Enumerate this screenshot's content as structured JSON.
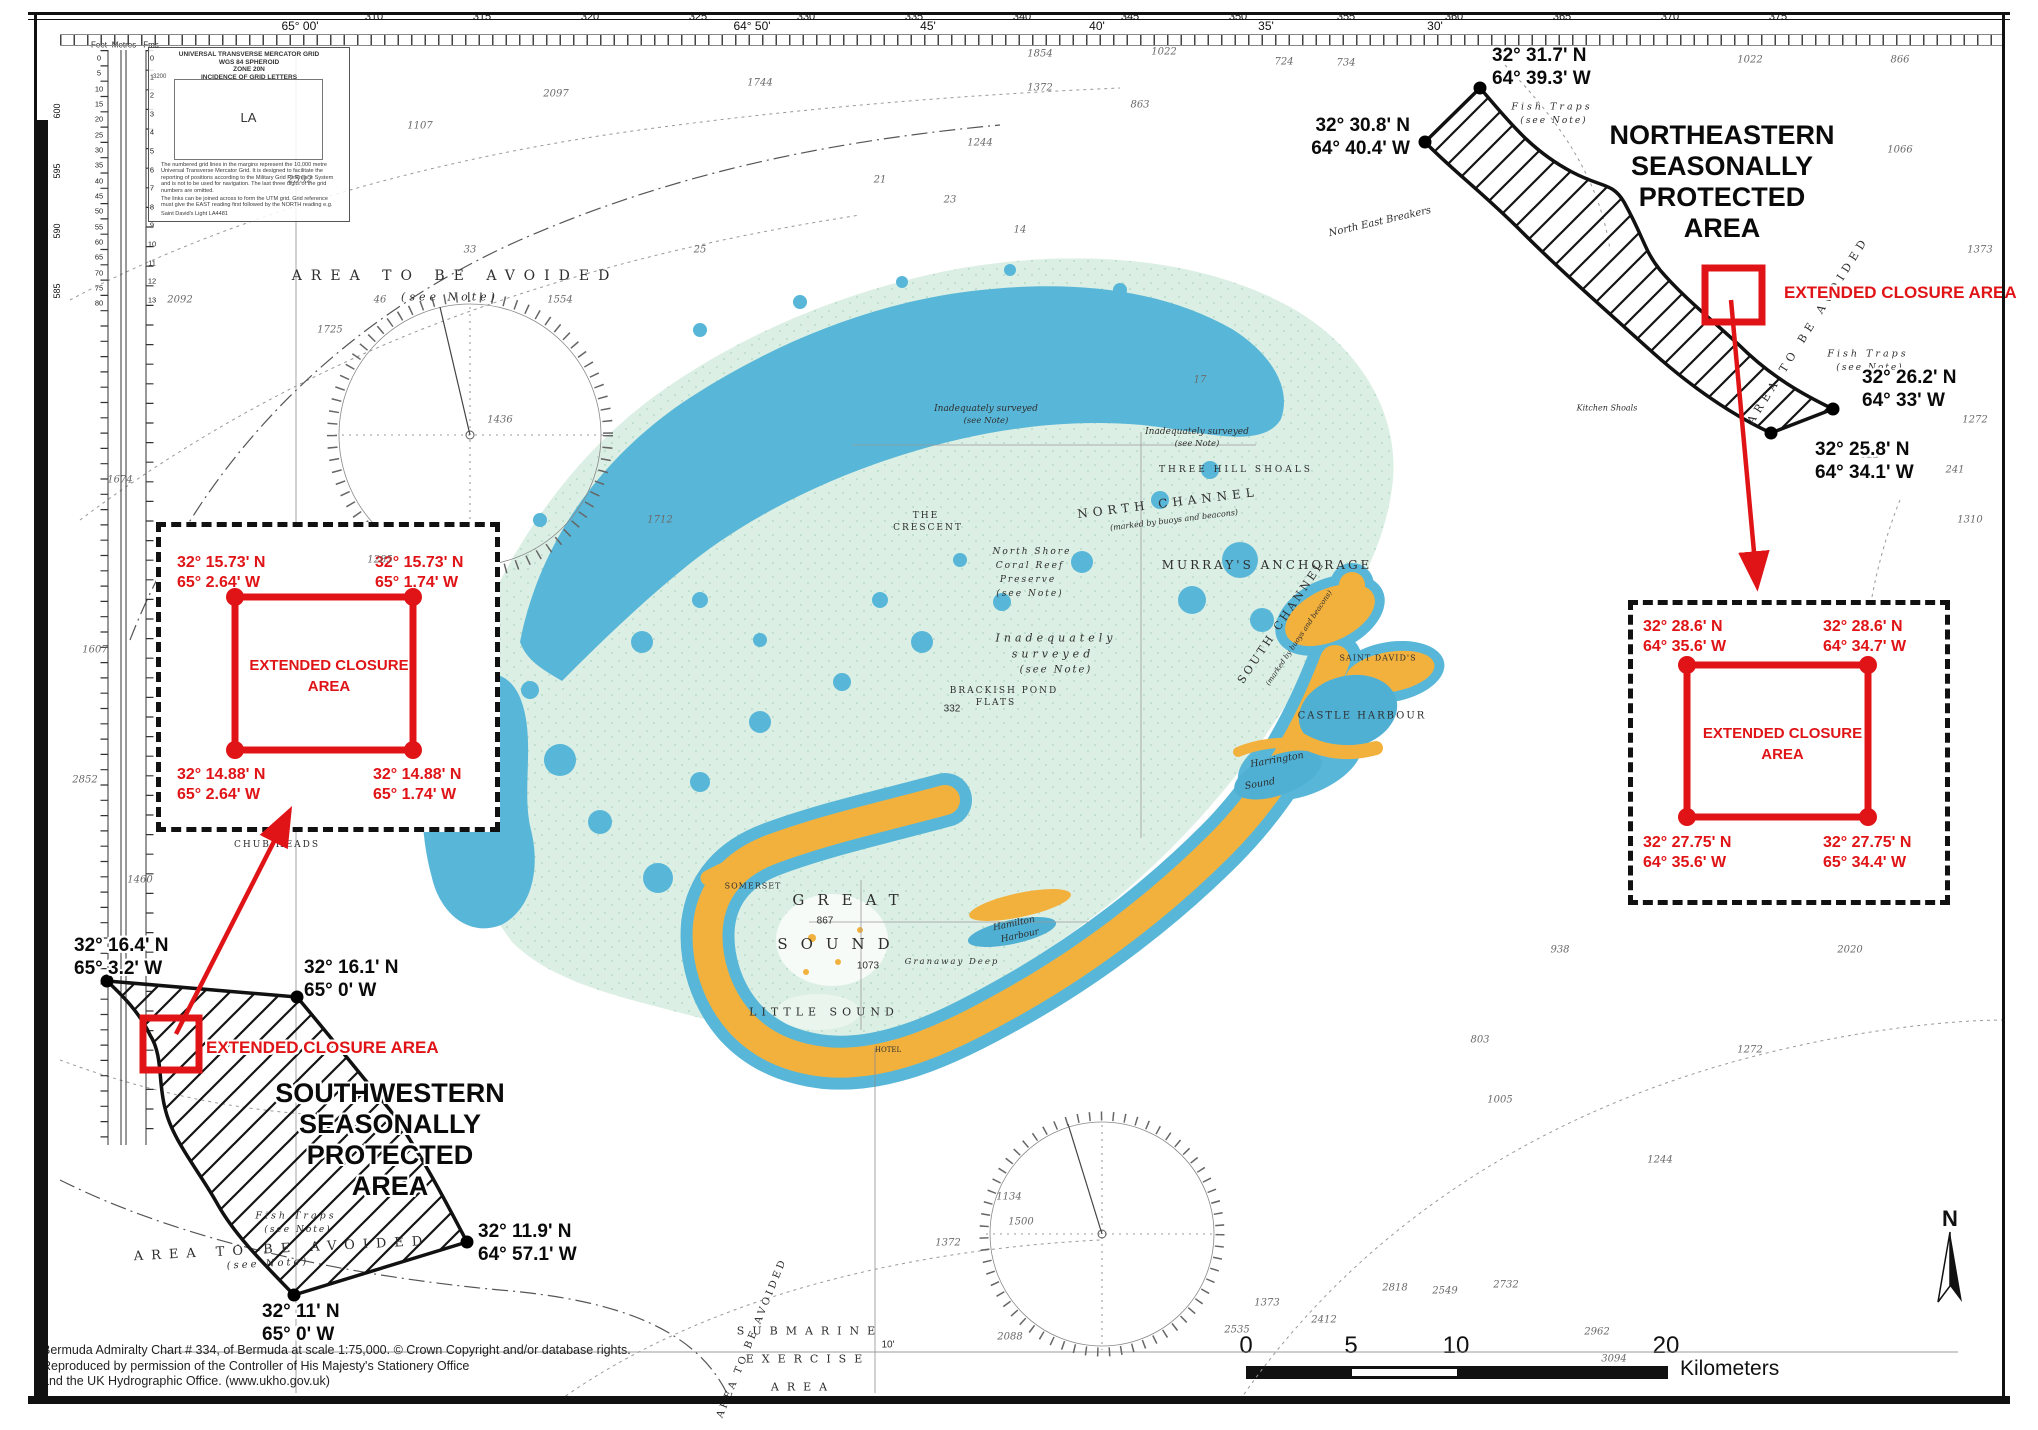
{
  "colors": {
    "red": "#e01417",
    "island_orange": "#f2b13d",
    "reef_blue": "#58b7d8",
    "platform_green": "#dcefe4",
    "hatch_black": "#111111"
  },
  "frame": {
    "north_label": "N"
  },
  "axis": {
    "top": [
      {
        "t": "310",
        "x": 374,
        "y": 17,
        "s": 11
      },
      {
        "t": "315",
        "x": 482,
        "y": 17,
        "s": 11
      },
      {
        "t": "320",
        "x": 590,
        "y": 17,
        "s": 11
      },
      {
        "t": "325",
        "x": 698,
        "y": 17,
        "s": 11
      },
      {
        "t": "330",
        "x": 806,
        "y": 17,
        "s": 11
      },
      {
        "t": "335",
        "x": 914,
        "y": 17,
        "s": 11
      },
      {
        "t": "340",
        "x": 1022,
        "y": 17,
        "s": 11
      },
      {
        "t": "345",
        "x": 1130,
        "y": 17,
        "s": 11
      },
      {
        "t": "350",
        "x": 1238,
        "y": 17,
        "s": 11
      },
      {
        "t": "355",
        "x": 1346,
        "y": 17,
        "s": 11
      },
      {
        "t": "360",
        "x": 1454,
        "y": 17,
        "s": 11
      },
      {
        "t": "365",
        "x": 1562,
        "y": 17,
        "s": 11
      },
      {
        "t": "370",
        "x": 1670,
        "y": 17,
        "s": 11
      },
      {
        "t": "375",
        "x": 1778,
        "y": 17,
        "s": 11
      },
      {
        "t": "65° 00'",
        "x": 300,
        "y": 26,
        "s": 12
      },
      {
        "t": "64° 50'",
        "x": 752,
        "y": 26,
        "s": 12
      },
      {
        "t": "45'",
        "x": 928,
        "y": 26,
        "s": 12
      },
      {
        "t": "40'",
        "x": 1097,
        "y": 26,
        "s": 12
      },
      {
        "t": "35'",
        "x": 1266,
        "y": 26,
        "s": 12
      },
      {
        "t": "30'",
        "x": 1435,
        "y": 26,
        "s": 12
      }
    ],
    "left": [
      {
        "t": "600",
        "x": 57,
        "y": 111,
        "s": 9,
        "r": -90
      },
      {
        "t": "595",
        "x": 57,
        "y": 171,
        "s": 9,
        "r": -90
      },
      {
        "t": "590",
        "x": 57,
        "y": 231,
        "s": 9,
        "r": -90
      },
      {
        "t": "585",
        "x": 57,
        "y": 291,
        "s": 9,
        "r": -90
      }
    ]
  },
  "legend": {
    "ruler_labels": [
      {
        "t": "Feet",
        "x": 99,
        "y": 45,
        "s": 8
      },
      {
        "t": "Metres",
        "x": 124,
        "y": 45,
        "s": 8
      },
      {
        "t": "Fms",
        "x": 151,
        "y": 45,
        "s": 8
      },
      {
        "t": "0",
        "x": 99,
        "y": 58,
        "s": 7.5
      },
      {
        "t": "5",
        "x": 99,
        "y": 73,
        "s": 7.5
      },
      {
        "t": "10",
        "x": 99,
        "y": 89,
        "s": 7.5
      },
      {
        "t": "15",
        "x": 99,
        "y": 104,
        "s": 7.5
      },
      {
        "t": "20",
        "x": 99,
        "y": 119,
        "s": 7.5
      },
      {
        "t": "25",
        "x": 99,
        "y": 135,
        "s": 7.5
      },
      {
        "t": "30",
        "x": 99,
        "y": 150,
        "s": 7.5
      },
      {
        "t": "35",
        "x": 99,
        "y": 165,
        "s": 7.5
      },
      {
        "t": "40",
        "x": 99,
        "y": 181,
        "s": 7.5
      },
      {
        "t": "45",
        "x": 99,
        "y": 196,
        "s": 7.5
      },
      {
        "t": "50",
        "x": 99,
        "y": 211,
        "s": 7.5
      },
      {
        "t": "55",
        "x": 99,
        "y": 227,
        "s": 7.5
      },
      {
        "t": "60",
        "x": 99,
        "y": 242,
        "s": 7.5
      },
      {
        "t": "65",
        "x": 99,
        "y": 257,
        "s": 7.5
      },
      {
        "t": "70",
        "x": 99,
        "y": 273,
        "s": 7.5
      },
      {
        "t": "75",
        "x": 99,
        "y": 288,
        "s": 7.5
      },
      {
        "t": "80",
        "x": 99,
        "y": 303,
        "s": 7.5
      },
      {
        "t": "0",
        "x": 152,
        "y": 58,
        "s": 7.5
      },
      {
        "t": "1",
        "x": 152,
        "y": 77,
        "s": 7.5
      },
      {
        "t": "2",
        "x": 152,
        "y": 95,
        "s": 7.5
      },
      {
        "t": "3",
        "x": 152,
        "y": 114,
        "s": 7.5
      },
      {
        "t": "4",
        "x": 152,
        "y": 132,
        "s": 7.5
      },
      {
        "t": "5",
        "x": 152,
        "y": 151,
        "s": 7.5
      },
      {
        "t": "6",
        "x": 152,
        "y": 170,
        "s": 7.5
      },
      {
        "t": "7",
        "x": 152,
        "y": 188,
        "s": 7.5
      },
      {
        "t": "8",
        "x": 152,
        "y": 207,
        "s": 7.5
      },
      {
        "t": "9",
        "x": 152,
        "y": 225,
        "s": 7.5
      },
      {
        "t": "10",
        "x": 152,
        "y": 244,
        "s": 7.5
      },
      {
        "t": "11",
        "x": 152,
        "y": 263,
        "s": 7.5
      },
      {
        "t": "12",
        "x": 152,
        "y": 281,
        "s": 7.5
      },
      {
        "t": "13",
        "x": 152,
        "y": 300,
        "s": 7.5
      }
    ],
    "utm_box": {
      "title_lines": [
        "UNIVERSAL TRANSVERSE MERCATOR GRID",
        "WGS 84 SPHEROID",
        "ZONE 20N",
        "INCIDENCE OF GRID LETTERS"
      ],
      "grid_letter": "LA",
      "corner_label": "3200",
      "notes": [
        "The numbered grid lines in the margins represent the 10,000 metre Universal Transverse Mercator Grid. It is designed to facilitate the reporting of positions according to the Military Grid Reference System and is not to be used for navigation. The last three digits of the grid numbers are omitted.",
        "The links can be joined across to form the UTM grid. Grid reference must give the EAST reading first followed by the NORTH reading e.g.",
        "Saint David's Light LA4481"
      ]
    }
  },
  "copyright_lines": [
    "Bermuda Admiralty Chart # 334, of Bermuda at scale 1:75,000. © Crown Copyright and/or database rights.",
    "Reproduced by permission of the Controller of His Majesty's Stationery Office",
    "and the UK Hydrographic Office. (www.ukho.gov.uk)"
  ],
  "scalebar": {
    "ticks": [
      "0",
      "5",
      "10",
      "20"
    ],
    "unit": "Kilometers"
  },
  "protected_areas": {
    "northeastern": {
      "title_lines": [
        "NORTHEASTERN",
        "SEASONALLY",
        "PROTECTED",
        "AREA"
      ],
      "closure_label": "EXTENDED CLOSURE AREA",
      "vertices": [
        {
          "lat": "32° 31.7' N",
          "lon": "64° 39.3' W"
        },
        {
          "lat": "32° 30.8' N",
          "lon": "64° 40.4' W"
        },
        {
          "lat": "32° 26.2' N",
          "lon": "64° 33' W"
        },
        {
          "lat": "32° 25.8' N",
          "lon": "64° 34.1' W"
        }
      ]
    },
    "southwestern": {
      "title_lines": [
        "SOUTHWESTERN",
        "SEASONALLY",
        "PROTECTED",
        "AREA"
      ],
      "closure_label": "EXTENDED CLOSURE AREA",
      "vertices": [
        {
          "lat": "32° 16.4' N",
          "lon": "65° 3.2' W"
        },
        {
          "lat": "32° 16.1' N",
          "lon": "65° 0' W"
        },
        {
          "lat": "32° 11.9' N",
          "lon": "64° 57.1' W"
        },
        {
          "lat": "32° 11' N",
          "lon": "65° 0' W"
        }
      ]
    }
  },
  "insets": {
    "northeastern": {
      "label_lines": [
        "EXTENDED CLOSURE",
        "AREA"
      ],
      "corners": {
        "tl": {
          "lat": "32° 28.6' N",
          "lon": "64° 35.6' W"
        },
        "tr": {
          "lat": "32° 28.6' N",
          "lon": "64° 34.7' W"
        },
        "bl": {
          "lat": "32° 27.75' N",
          "lon": "64° 35.6' W"
        },
        "br": {
          "lat": "32° 27.75' N",
          "lon": "65° 34.4' W"
        }
      }
    },
    "southwestern": {
      "label_lines": [
        "EXTENDED CLOSURE",
        "AREA"
      ],
      "corners": {
        "tl": {
          "lat": "32° 15.73' N",
          "lon": "65° 2.64' W"
        },
        "tr": {
          "lat": "32° 15.73' N",
          "lon": "65° 1.74' W"
        },
        "bl": {
          "lat": "32° 14.88' N",
          "lon": "65° 2.64' W"
        },
        "br": {
          "lat": "32° 14.88' N",
          "lon": "65° 1.74' W"
        }
      }
    }
  },
  "map_labels": [
    {
      "n": "area-to-be-avoided-nw",
      "t": "AREA TO BE AVOIDED",
      "x": 455,
      "y": 276,
      "s": 14,
      "ls": 9
    },
    {
      "n": "area-to-be-avoided-nw-note",
      "t": "(see Note)",
      "x": 450,
      "y": 297,
      "s": 11,
      "ls": 4,
      "c": "it"
    },
    {
      "n": "north-channel",
      "t": "NORTH CHANNEL",
      "x": 1168,
      "y": 503,
      "s": 12,
      "ls": 5,
      "r": -7
    },
    {
      "n": "north-channel-note",
      "t": "(marked by buoys and beacons)",
      "x": 1174,
      "y": 520,
      "s": 8,
      "c": "it",
      "r": -7
    },
    {
      "n": "murrays-anchorage",
      "t": "MURRAY'S ANCHORAGE",
      "x": 1267,
      "y": 565,
      "s": 12,
      "ls": 3
    },
    {
      "n": "the-crescent",
      "t": "THE",
      "x": 926,
      "y": 516,
      "s": 9,
      "ls": 2
    },
    {
      "n": "the-crescent",
      "t": "CRESCENT",
      "x": 928,
      "y": 528,
      "s": 9,
      "ls": 2
    },
    {
      "n": "coral-reef-preserve",
      "t": "North Shore",
      "x": 1032,
      "y": 552,
      "s": 9,
      "c": "it",
      "ls": 2
    },
    {
      "n": "coral-reef-preserve",
      "t": "Coral Reef",
      "x": 1030,
      "y": 566,
      "s": 9,
      "c": "it",
      "ls": 2
    },
    {
      "n": "coral-reef-preserve",
      "t": "Preserve",
      "x": 1028,
      "y": 580,
      "s": 9,
      "c": "it",
      "ls": 2
    },
    {
      "n": "coral-reef-preserve",
      "t": "(see Note)",
      "x": 1030,
      "y": 594,
      "s": 9,
      "c": "it",
      "ls": 2
    },
    {
      "n": "inadequately-surveyed",
      "t": "Inadequately",
      "x": 1056,
      "y": 638,
      "s": 11,
      "c": "it",
      "ls": 4
    },
    {
      "n": "inadequately-surveyed",
      "t": "surveyed",
      "x": 1053,
      "y": 654,
      "s": 11,
      "c": "it",
      "ls": 4
    },
    {
      "n": "inadequately-surveyed",
      "t": "(see Note)",
      "x": 1056,
      "y": 670,
      "s": 10,
      "c": "it",
      "ls": 2
    },
    {
      "n": "inadequately-surveyed",
      "t": "Inadequately surveyed",
      "x": 1197,
      "y": 432,
      "s": 9,
      "c": "it"
    },
    {
      "n": "inadequately-surveyed",
      "t": "(see Note)",
      "x": 1197,
      "y": 444,
      "s": 8.5,
      "c": "it"
    },
    {
      "n": "inadequately-surveyed",
      "t": "Inadequately surveyed",
      "x": 986,
      "y": 409,
      "s": 9,
      "c": "it"
    },
    {
      "n": "inadequately-surveyed",
      "t": "(see Note)",
      "x": 986,
      "y": 421,
      "s": 8.5,
      "c": "it"
    },
    {
      "n": "brackish-pond-flats",
      "t": "BRACKISH POND",
      "x": 1004,
      "y": 691,
      "s": 9,
      "ls": 2
    },
    {
      "n": "brackish-pond-flats",
      "t": "FLATS",
      "x": 996,
      "y": 703,
      "s": 9,
      "ls": 2
    },
    {
      "n": "three-hill-shoals",
      "t": "THREE HILL SHOALS",
      "x": 1236,
      "y": 470,
      "s": 9,
      "ls": 3
    },
    {
      "n": "south-channel",
      "t": "SOUTH CHANNEL",
      "x": 1281,
      "y": 622,
      "s": 11,
      "ls": 3,
      "r": -56
    },
    {
      "n": "south-channel-note",
      "t": "(marked by buoys and beacons)",
      "x": 1299,
      "y": 638,
      "s": 7,
      "c": "it",
      "r": -56
    },
    {
      "n": "great-sound",
      "t": "GREAT",
      "x": 852,
      "y": 900,
      "s": 15,
      "ls": 13
    },
    {
      "n": "great-sound",
      "t": "SOUND",
      "x": 840,
      "y": 944,
      "s": 15,
      "ls": 13
    },
    {
      "n": "little-sound",
      "t": "LITTLE SOUND",
      "x": 824,
      "y": 1012,
      "s": 11,
      "ls": 5
    },
    {
      "n": "hamilton-harbour",
      "t": "Hamilton",
      "x": 1014,
      "y": 924,
      "s": 9,
      "c": "it",
      "r": -12
    },
    {
      "n": "hamilton-harbour",
      "t": "Harbour",
      "x": 1020,
      "y": 936,
      "s": 9,
      "c": "it",
      "r": -12
    },
    {
      "n": "castle-harbour",
      "t": "CASTLE HARBOUR",
      "x": 1362,
      "y": 716,
      "s": 10,
      "ls": 2
    },
    {
      "n": "harrington-sound",
      "t": "Harrington",
      "x": 1277,
      "y": 760,
      "s": 9.5,
      "c": "it",
      "r": -10
    },
    {
      "n": "harrington-sound",
      "t": "Sound",
      "x": 1260,
      "y": 784,
      "s": 9.5,
      "c": "it",
      "r": -10
    },
    {
      "n": "saint-davids",
      "t": "SAINT DAVID'S",
      "x": 1378,
      "y": 658,
      "s": 8,
      "ls": 1
    },
    {
      "n": "somerset",
      "t": "SOMERSET",
      "x": 753,
      "y": 886,
      "s": 8,
      "ls": 1
    },
    {
      "n": "north-east-breakers",
      "t": "North East Breakers",
      "x": 1380,
      "y": 222,
      "s": 10,
      "c": "it",
      "r": -13
    },
    {
      "n": "fish-traps",
      "t": "Fish Traps",
      "x": 1552,
      "y": 107,
      "s": 9.5,
      "c": "it",
      "ls": 3
    },
    {
      "n": "fish-traps",
      "t": "(see Note)",
      "x": 1554,
      "y": 121,
      "s": 9,
      "c": "it",
      "ls": 2
    },
    {
      "n": "fish-traps",
      "t": "Fish Traps",
      "x": 1868,
      "y": 354,
      "s": 9.5,
      "c": "it",
      "ls": 3
    },
    {
      "n": "fish-traps",
      "t": "(see Note)",
      "x": 1870,
      "y": 368,
      "s": 9,
      "c": "it",
      "ls": 2
    },
    {
      "n": "fish-traps",
      "t": "Fish Traps",
      "x": 296,
      "y": 1216,
      "s": 9.5,
      "c": "it",
      "ls": 3
    },
    {
      "n": "fish-traps",
      "t": "(see Note)",
      "x": 298,
      "y": 1230,
      "s": 9,
      "c": "it",
      "ls": 2
    },
    {
      "n": "area-to-be-avoided-sw",
      "t": "AREA TO BE AVOIDED",
      "x": 282,
      "y": 1249,
      "s": 13,
      "ls": 8,
      "r": -3
    },
    {
      "n": "area-to-be-avoided-sw-note",
      "t": "(see Note)",
      "x": 268,
      "y": 1264,
      "s": 10,
      "ls": 3,
      "r": -3,
      "c": "it"
    },
    {
      "n": "area-to-be-avoided-e",
      "t": "AREA TO BE AVOIDED",
      "x": 1808,
      "y": 330,
      "s": 11,
      "ls": 5,
      "r": -58
    },
    {
      "n": "area-to-be-avoided-s",
      "t": "AREA TO BE AVOIDED",
      "x": 752,
      "y": 1338,
      "s": 10,
      "ls": 3,
      "r": -68
    },
    {
      "n": "submarine-exercise-area",
      "t": "SUBMARINE",
      "x": 810,
      "y": 1331,
      "s": 11,
      "ls": 8
    },
    {
      "n": "submarine-exercise-area",
      "t": "EXERCISE",
      "x": 808,
      "y": 1359,
      "s": 11,
      "ls": 8
    },
    {
      "n": "submarine-exercise-area",
      "t": "AREA",
      "x": 803,
      "y": 1387,
      "s": 11,
      "ls": 8
    },
    {
      "n": "chub-heads",
      "t": "CHUB HEADS",
      "x": 277,
      "y": 845,
      "s": 9,
      "ls": 2
    },
    {
      "n": "kitchen-shoals",
      "t": "Kitchen Shoals",
      "x": 1607,
      "y": 408,
      "s": 8,
      "c": "it"
    },
    {
      "n": "hotel",
      "t": "HOTEL",
      "x": 888,
      "y": 1050,
      "s": 7
    },
    {
      "n": "granaway-deep",
      "t": "Granaway Deep",
      "x": 952,
      "y": 962,
      "s": 8.5,
      "c": "it",
      "ls": 2
    },
    {
      "n": "panel-number",
      "t": "867",
      "x": 825,
      "y": 921,
      "s": 10,
      "c": "sans"
    },
    {
      "n": "panel-number",
      "t": "1073",
      "x": 868,
      "y": 966,
      "s": 10,
      "c": "sans"
    },
    {
      "n": "panel-number",
      "t": "332",
      "x": 952,
      "y": 709,
      "s": 10,
      "c": "sans"
    },
    {
      "n": "latitude-label",
      "t": "10'",
      "x": 888,
      "y": 1345,
      "s": 10,
      "c": "sans"
    }
  ],
  "soundings": [
    {
      "t": "1854",
      "x": 1040,
      "y": 54
    },
    {
      "t": "1022",
      "x": 1164,
      "y": 52
    },
    {
      "t": "724",
      "x": 1284,
      "y": 62
    },
    {
      "t": "734",
      "x": 1346,
      "y": 63
    },
    {
      "t": "1372",
      "x": 1040,
      "y": 88
    },
    {
      "t": "863",
      "x": 1140,
      "y": 105
    },
    {
      "t": "1244",
      "x": 980,
      "y": 143
    },
    {
      "t": "1744",
      "x": 760,
      "y": 83
    },
    {
      "t": "2097",
      "x": 556,
      "y": 94
    },
    {
      "t": "1107",
      "x": 420,
      "y": 126
    },
    {
      "t": "2592",
      "x": 300,
      "y": 180
    },
    {
      "t": "2092",
      "x": 180,
      "y": 300
    },
    {
      "t": "1674",
      "x": 120,
      "y": 480
    },
    {
      "t": "1607",
      "x": 95,
      "y": 650
    },
    {
      "t": "2852",
      "x": 85,
      "y": 780
    },
    {
      "t": "1460",
      "x": 140,
      "y": 880
    },
    {
      "t": "1725",
      "x": 330,
      "y": 330
    },
    {
      "t": "1554",
      "x": 560,
      "y": 300
    },
    {
      "t": "1436",
      "x": 500,
      "y": 420
    },
    {
      "t": "1712",
      "x": 660,
      "y": 520
    },
    {
      "t": "1285",
      "x": 380,
      "y": 560
    },
    {
      "t": "2535",
      "x": 1237,
      "y": 1330
    },
    {
      "t": "1373",
      "x": 1267,
      "y": 1303
    },
    {
      "t": "2412",
      "x": 1324,
      "y": 1320
    },
    {
      "t": "2818",
      "x": 1395,
      "y": 1288
    },
    {
      "t": "2549",
      "x": 1445,
      "y": 1291
    },
    {
      "t": "2732",
      "x": 1506,
      "y": 1285
    },
    {
      "t": "2962",
      "x": 1597,
      "y": 1332
    },
    {
      "t": "3094",
      "x": 1614,
      "y": 1359
    },
    {
      "t": "2088",
      "x": 1010,
      "y": 1337
    },
    {
      "t": "1500",
      "x": 1021,
      "y": 1222
    },
    {
      "t": "1134",
      "x": 1009,
      "y": 1197
    },
    {
      "t": "1372",
      "x": 948,
      "y": 1243
    },
    {
      "t": "1244",
      "x": 1660,
      "y": 1160
    },
    {
      "t": "1272",
      "x": 1750,
      "y": 1050
    },
    {
      "t": "2020",
      "x": 1850,
      "y": 950
    },
    {
      "t": "1005",
      "x": 1500,
      "y": 1100
    },
    {
      "t": "938",
      "x": 1560,
      "y": 950
    },
    {
      "t": "803",
      "x": 1480,
      "y": 1040
    },
    {
      "t": "1310",
      "x": 1970,
      "y": 520
    },
    {
      "t": "1272",
      "x": 1975,
      "y": 420
    },
    {
      "t": "1066",
      "x": 1900,
      "y": 150
    },
    {
      "t": "1373",
      "x": 1980,
      "y": 250
    },
    {
      "t": "1022",
      "x": 1750,
      "y": 60
    },
    {
      "t": "866",
      "x": 1900,
      "y": 60
    },
    {
      "t": "622",
      "x": 1870,
      "y": 455
    },
    {
      "t": "241",
      "x": 1955,
      "y": 470
    },
    {
      "t": "21",
      "x": 880,
      "y": 180
    },
    {
      "t": "23",
      "x": 950,
      "y": 200
    },
    {
      "t": "14",
      "x": 1020,
      "y": 230
    },
    {
      "t": "25",
      "x": 700,
      "y": 250
    },
    {
      "t": "17",
      "x": 1200,
      "y": 380
    },
    {
      "t": "33",
      "x": 470,
      "y": 250
    },
    {
      "t": "46",
      "x": 380,
      "y": 300
    }
  ]
}
